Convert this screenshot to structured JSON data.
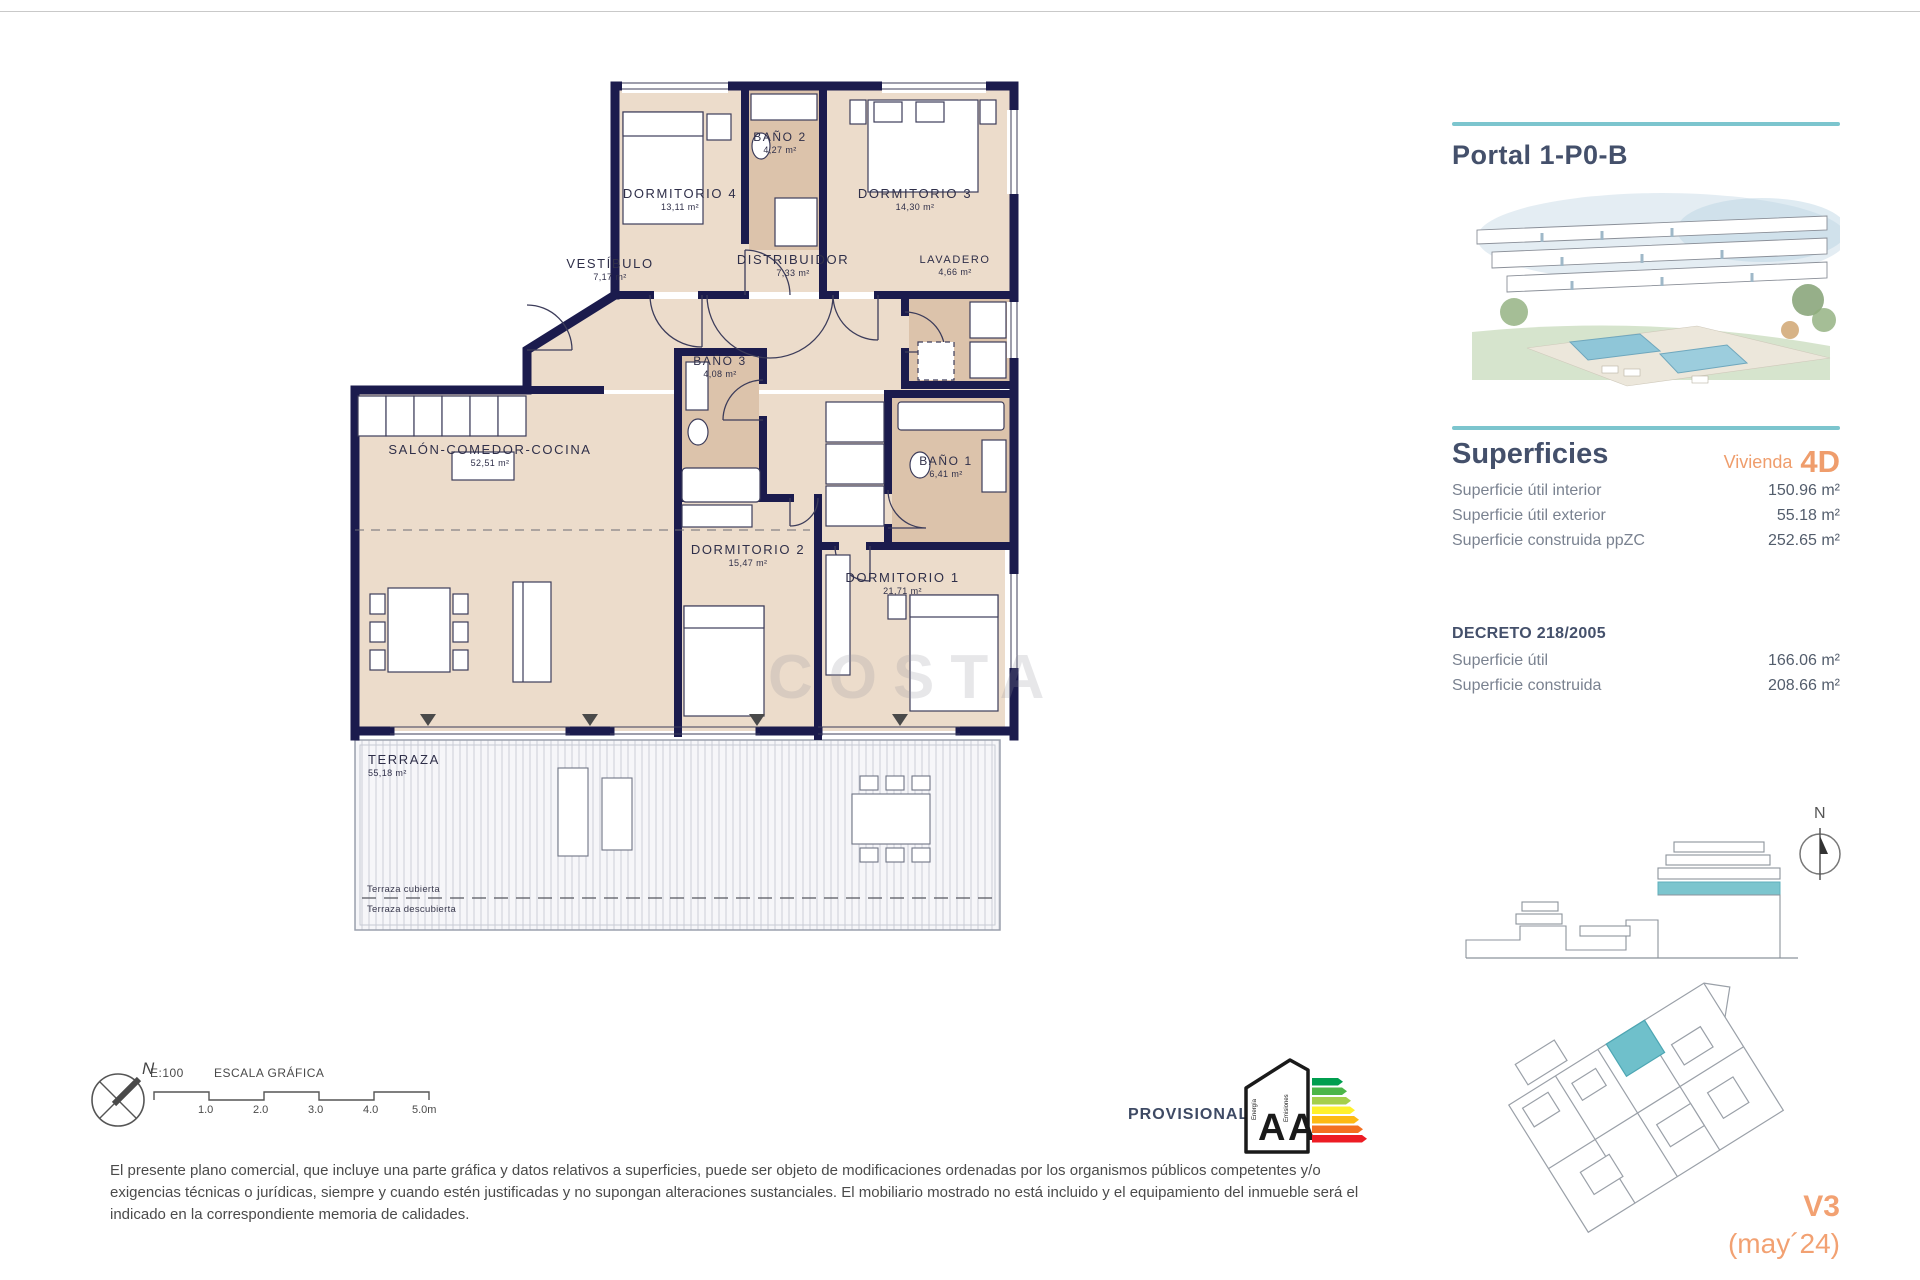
{
  "plan": {
    "rooms": [
      {
        "name": "DORMITORIO 4",
        "area": "13,11 m²"
      },
      {
        "name": "BAÑO 2",
        "area": "4,27 m²"
      },
      {
        "name": "DORMITORIO 3",
        "area": "14,30 m²"
      },
      {
        "name": "VESTÍBULO",
        "area": "7,17 m²"
      },
      {
        "name": "DISTRIBUIDOR",
        "area": "7,33 m²"
      },
      {
        "name": "LAVADERO",
        "area": "4,66 m²"
      },
      {
        "name": "BAÑO 3",
        "area": "4,08 m²"
      },
      {
        "name": "BAÑO 1",
        "area": "6,41 m²"
      },
      {
        "name": "SALÓN-COMEDOR-COCINA",
        "area": "52,51 m²"
      },
      {
        "name": "DORMITORIO 2",
        "area": "15,47 m²"
      },
      {
        "name": "DORMITORIO 1",
        "area": "21,71 m²"
      },
      {
        "name": "TERRAZA",
        "area": "55,18 m²"
      }
    ],
    "terrace_notes": [
      "Terraza cubierta",
      "Terraza descubierta"
    ],
    "watermark": "COSTA",
    "compass_north": "N"
  },
  "scale_bar": {
    "ratio": "E:100",
    "title": "ESCALA GRÁFICA",
    "ticks": [
      "1.0",
      "2.0",
      "3.0",
      "4.0",
      "5.0m"
    ]
  },
  "energy": {
    "status_label": "PROVISIONAL",
    "energy_letter": "A",
    "emissions_letter": "A",
    "energy_word": "Energía",
    "emissions_word": "Emisiones"
  },
  "disclaimer": "El presente plano comercial, que incluye una parte gráfica y datos relativos a superficies, puede ser objeto de modificaciones ordenadas por los organismos públicos competentes y/o exigencias técnicas o jurídicas, siempre y cuando estén justificadas y no supongan alteraciones sustanciales. El mobiliario mostrado no está incluido y el equipamiento del inmueble será el indicado en la correspondiente memoria de calidades.",
  "sidebar": {
    "title": "Portal 1-P0-B",
    "superficies": {
      "heading": "Superficies",
      "vivienda_label": "Vivienda",
      "vivienda_code": "4D",
      "rows": [
        {
          "label": "Superficie útil interior",
          "value": "150.96 m²"
        },
        {
          "label": "Superficie útil exterior",
          "value": "55.18 m²"
        },
        {
          "label": "Superficie construida ppZC",
          "value": "252.65 m²"
        }
      ]
    },
    "decreto": {
      "heading": "DECRETO 218/2005",
      "rows": [
        {
          "label": "Superficie útil",
          "value": "166.06 m²"
        },
        {
          "label": "Superficie construida",
          "value": "208.66 m²"
        }
      ]
    },
    "north_label": "N",
    "version": "V3",
    "date_label": "(may´24)"
  },
  "colors": {
    "teal": "#7cc5ce",
    "orange": "#ef9d6c",
    "heading_navy": "#44506b",
    "wall_navy": "#1b1b4d"
  }
}
